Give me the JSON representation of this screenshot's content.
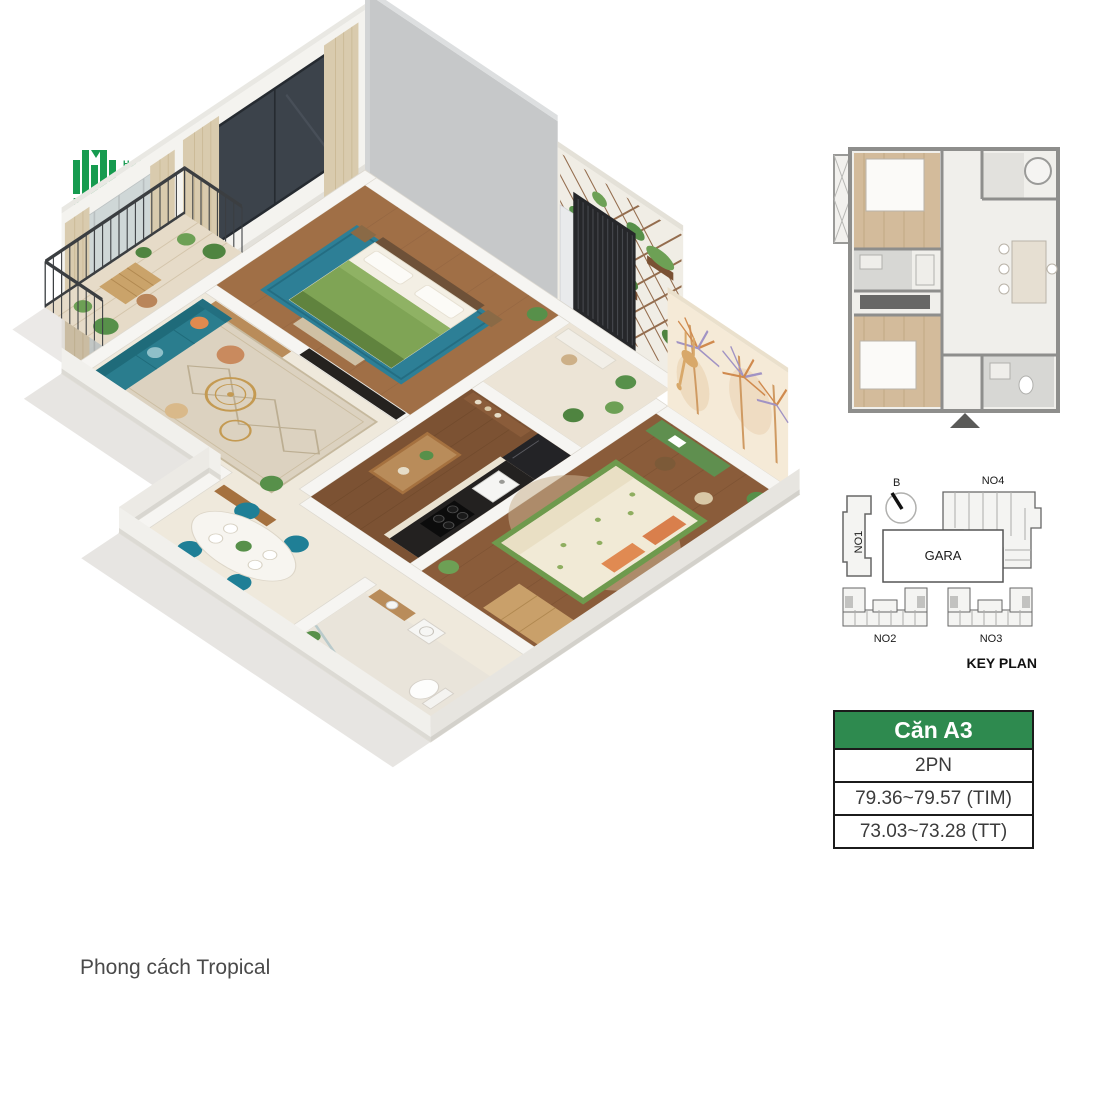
{
  "logo": {
    "hanoi": "HANOI",
    "melody": "ELODY",
    "residences": "RESIDENCES"
  },
  "caption": "Phong cách Tropical",
  "key_plan": {
    "title": "KEY PLAN",
    "compass": "B",
    "no1": "NO1",
    "no2": "NO2",
    "no3": "NO3",
    "no4": "NO4",
    "gara": "GARA"
  },
  "unit_table": {
    "header": "Căn A3",
    "rows": [
      "2PN",
      "79.36~79.57 (TIM)",
      "73.03~73.28 (TT)"
    ]
  },
  "colors": {
    "brand_green": "#169b4f",
    "table_header_green": "#2e8a4f",
    "sofa_teal": "#2a7d8e",
    "dining_chair_teal": "#1f7f96",
    "bed_green": "#7fa455",
    "bedroom_rug_blue": "#2d7f96",
    "wood_floor": "#9e6c44",
    "tile_floor": "#efe9dc",
    "exterior_wall_gray": "#c6c8c9",
    "mural_beige": "#f5ead7",
    "mural_palm_orange": "#d08a4e",
    "mural_palm_purple": "#a193c4",
    "trellis_brown": "#8a5f3e"
  }
}
